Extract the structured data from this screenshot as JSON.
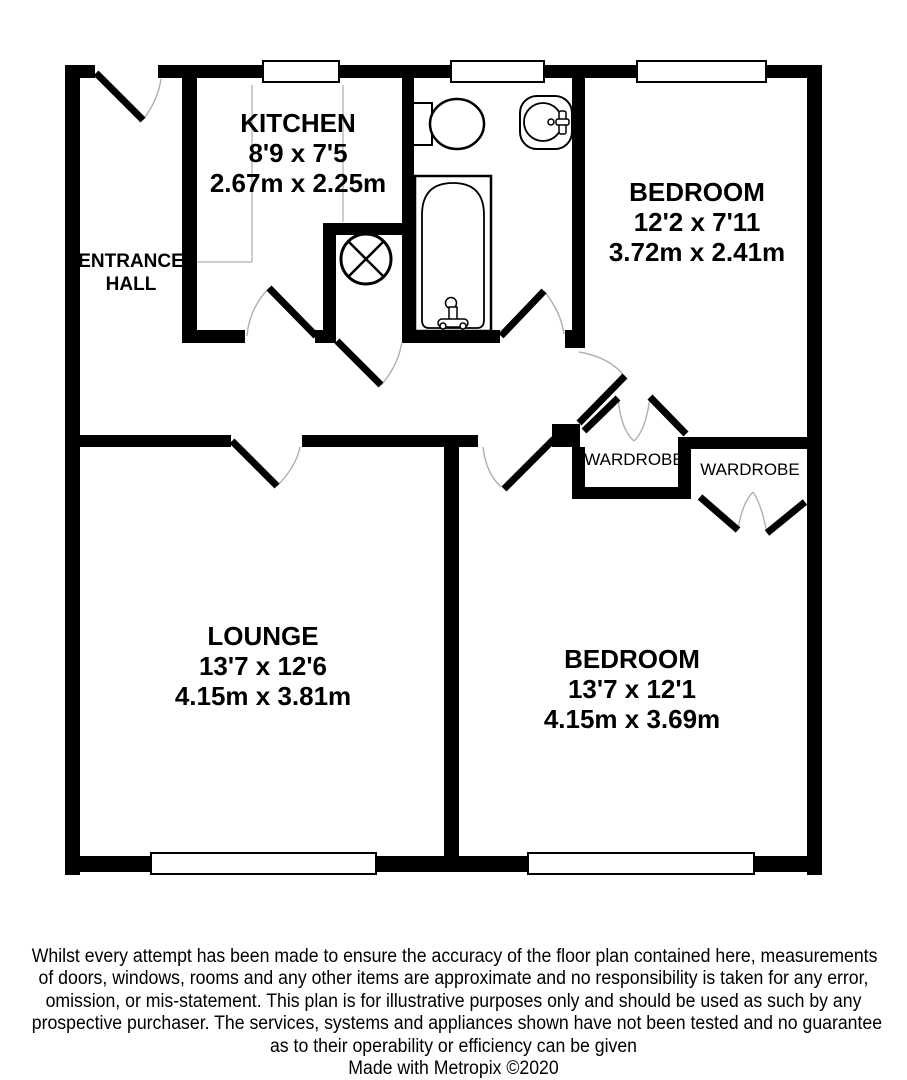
{
  "plan": {
    "type": "floorplan",
    "rooms": {
      "entrance_hall": {
        "line1": "ENTRANCE",
        "line2": "HALL"
      },
      "kitchen": {
        "name": "KITCHEN",
        "imperial": "8'9 x 7'5",
        "metric": "2.67m x 2.25m"
      },
      "bedroom1": {
        "name": "BEDROOM",
        "imperial": "12'2 x 7'11",
        "metric": "3.72m x 2.41m"
      },
      "lounge": {
        "name": "LOUNGE",
        "imperial": "13'7 x 12'6",
        "metric": "4.15m x 3.81m"
      },
      "bedroom2": {
        "name": "BEDROOM",
        "imperial": "13'7 x 12'1",
        "metric": "4.15m x 3.69m"
      },
      "wardrobe_left": {
        "name": "WARDROBE"
      },
      "wardrobe_right": {
        "name": "WARDROBE"
      }
    },
    "fixtures": [
      "toilet-icon",
      "sink-icon",
      "bath-icon",
      "extractor-fan-icon"
    ],
    "colors": {
      "wall": "#000000",
      "background": "#ffffff",
      "swing_arc": "#b0b0b0",
      "counter_line": "#b0b0b0"
    }
  },
  "disclaimer": {
    "lines": [
      "Whilst every attempt has been made to ensure the accuracy of the floor plan contained here, measurements",
      "of doors, windows, rooms and any other items are approximate and no responsibility is taken for any error,",
      "omission, or mis-statement. This plan is for illustrative purposes only and should be used as such by any",
      "prospective purchaser. The services, systems and appliances shown have not been tested and no guarantee",
      "as to their operability or efficiency can be given"
    ],
    "credit": "Made with Metropix ©2020"
  }
}
